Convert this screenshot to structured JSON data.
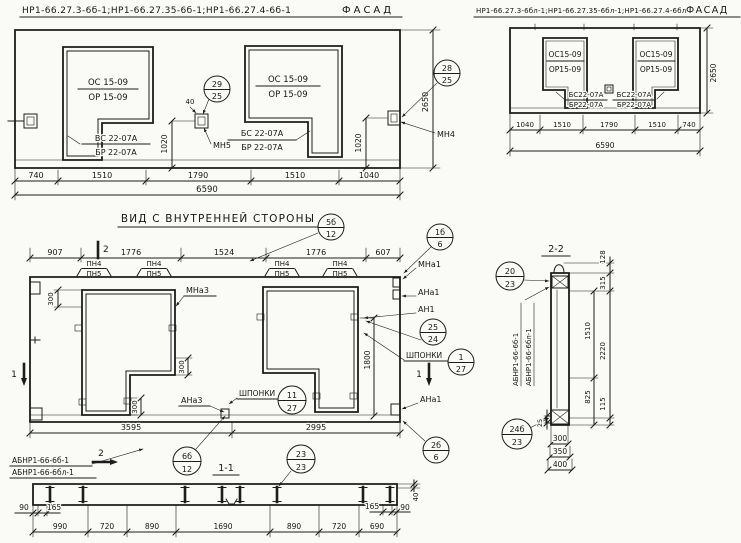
{
  "colors": {
    "ink": "#1c1c1c",
    "paper": "#fafaf7"
  },
  "facade_left": {
    "title_codes": "НР1-66.27.3-6б-1;НР1-66.27.35-6б-1;НР1-66.27.4-6б-1",
    "title_view": "ФАСАД",
    "win_left": {
      "l1": "ОС 15-09",
      "l2": "ОР 15-09",
      "s1": "ВС 22-07А",
      "s2": "БР 22-07А"
    },
    "win_right": {
      "l1": "ОС 15-09",
      "l2": "ОР 15-09",
      "s1": "БС 22-07А",
      "s2": "БР 22-07А"
    },
    "balloon_mid": {
      "top": "29",
      "bot": "25"
    },
    "balloon_right": {
      "top": "28",
      "bot": "25"
    },
    "anchor_mid": "МН5",
    "anchor_right": "МН4",
    "dim_40": "40",
    "dim_1020a": "1020",
    "dim_1020b": "1020",
    "dim_2650": "2650",
    "dims": [
      "740",
      "1510",
      "1790",
      "1510",
      "1040"
    ],
    "total": "6590"
  },
  "facade_right": {
    "title_codes": "НР1-66.27.3-6бл-1;НР1-66.27.35-6бл-1;НР1-66.27.4-6бл-1",
    "title_view": "ФАСАД",
    "win_left": {
      "l1": "ОС15-09",
      "l2": "ОР15-09"
    },
    "win_right": {
      "l1": "ОС15-09",
      "l2": "ОР15-09"
    },
    "sill_left": {
      "l1": "БС22-07А",
      "l2": "БР22-07А"
    },
    "sill_right": {
      "l1": "БС22-07А",
      "l2": "БР22-07А"
    },
    "dim_2650": "2650",
    "dims": [
      "1040",
      "1510",
      "1790",
      "1510",
      "740"
    ],
    "total": "6590"
  },
  "inner": {
    "title": "ВИД С ВНУТРЕННЕЙ СТОРОНЫ",
    "balloon_title": {
      "top": "5б",
      "bot": "12"
    },
    "balloon_corner": {
      "top": "1б",
      "bot": "6"
    },
    "dims_top": [
      "907",
      "1776",
      "1524",
      "1776",
      "607"
    ],
    "pn1": "ПН4",
    "pn2": "ПН5",
    "mna3": "МНа3",
    "ana3": "АНа3",
    "mna1": "МНа1",
    "ana1": "АНа1",
    "an1": "АН1",
    "ana1b": "АНа1",
    "balloon_25_24": {
      "top": "25",
      "bot": "24"
    },
    "shponki1": "ШПОНКИ",
    "shponki2": "ШПОНКИ",
    "balloon_sh1": {
      "top": "1",
      "bot": "27"
    },
    "balloon_sh2": {
      "top": "11",
      "bot": "27"
    },
    "balloon_corner2": {
      "top": "2б",
      "bot": "6"
    },
    "dim_300": "300",
    "dim_1800": "1800",
    "dims_bottom": [
      "3595",
      "2995"
    ],
    "mark2": "2",
    "mark1": "1"
  },
  "sec1": {
    "title": "1-1",
    "label1": "АБНР1-66-6б-1",
    "label2": "АБНР1-66-6бл-1",
    "balloon_a": {
      "top": "6б",
      "bot": "12"
    },
    "balloon_b": {
      "top": "23",
      "bot": "23"
    },
    "d90l": "90",
    "d165l": "165",
    "dims": [
      "990",
      "720",
      "890",
      "1690",
      "890",
      "720",
      "690"
    ],
    "d165r": "165",
    "d90r": "90",
    "d40": "40"
  },
  "sec2": {
    "title": "2-2",
    "balloon_a": {
      "top": "20",
      "bot": "23"
    },
    "balloon_b": {
      "top": "24б",
      "bot": "23"
    },
    "label1": "АБНР1-66-6б-1",
    "label2": "АБНР1-66-6бл-1",
    "d128": "128",
    "d315": "315",
    "d1510": "1510",
    "d2220": "2220",
    "d825": "825",
    "d115": "115",
    "d25": "25",
    "dims_bottom": [
      "300",
      "350",
      "400"
    ]
  }
}
